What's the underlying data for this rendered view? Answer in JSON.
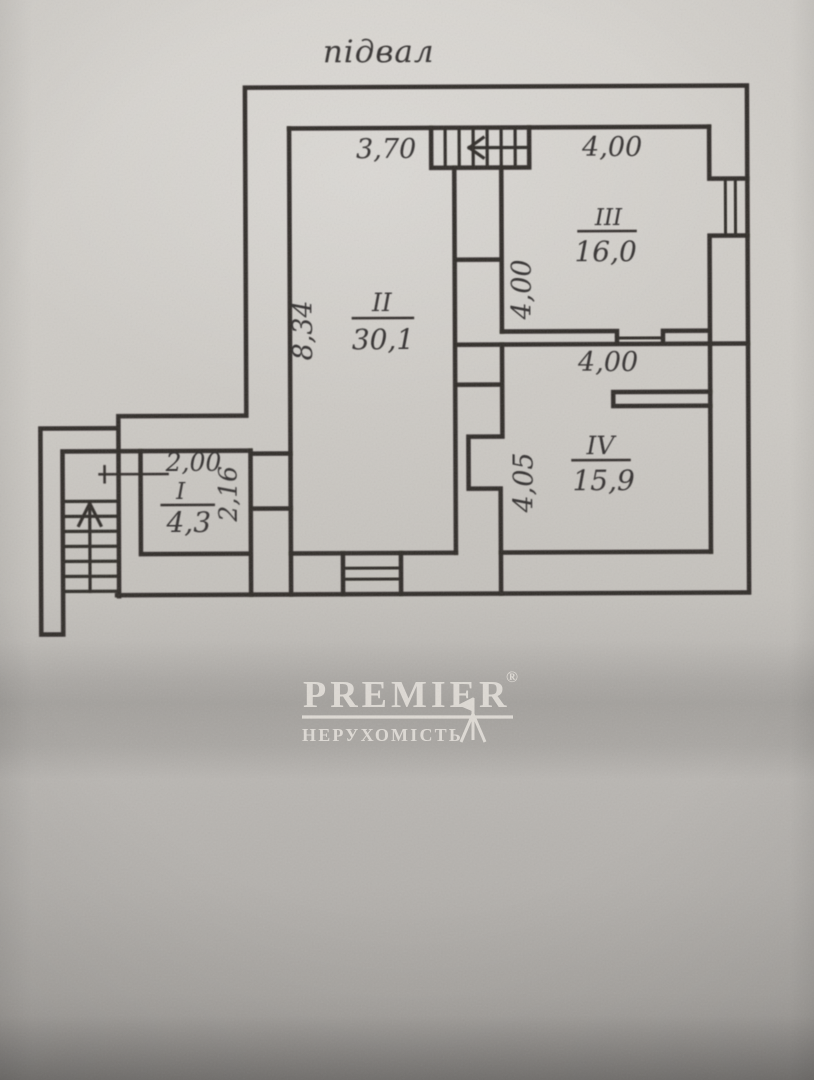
{
  "title": "підвал",
  "rooms": [
    {
      "number": "I",
      "area": "4,3"
    },
    {
      "number": "II",
      "area": "30,1"
    },
    {
      "number": "III",
      "area": "16,0"
    },
    {
      "number": "IV",
      "area": "15,9"
    }
  ],
  "dims": {
    "room2_width_top": "3,70",
    "room3_width_top": "4,00",
    "room2_height_left": "8,34",
    "room3_height_left": "4,00",
    "room4_width_top": "4,00",
    "room4_height_left": "4,05",
    "room1_width_top": "2,00",
    "room1_height_right": "2,16"
  },
  "logo": {
    "brand": "PREMIER",
    "registered": "®",
    "tagline": "НЕРУХОМІСТЬ"
  },
  "colors": {
    "ink": "#312e2b",
    "paper": "#cecbc6",
    "logo_text": "#e3dfd9"
  }
}
